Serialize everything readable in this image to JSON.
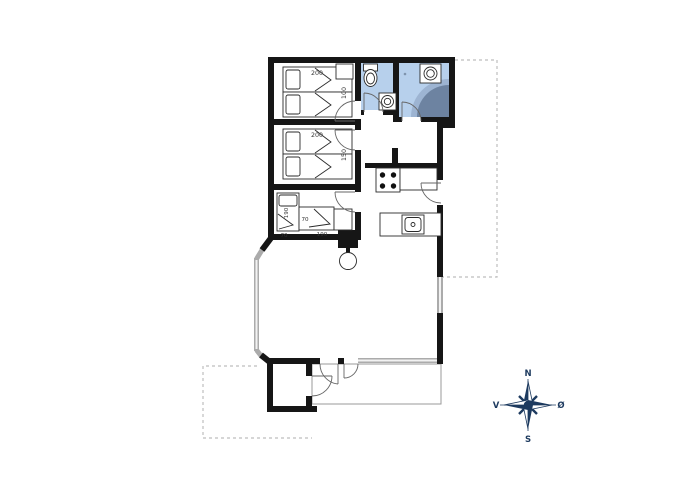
{
  "title": "Summer house floor plan",
  "colors": {
    "wall": "#161616",
    "room_blue": "#b7d0ec",
    "shower_mid": "#9db4d2",
    "shower_dark": "#6d83a1",
    "window_gray": "#ababab",
    "window_core": "#f2f2f2",
    "navy": "#1d3a5f",
    "dash_gray": "#bdbdbd",
    "thin_line": "#9a9a9a",
    "furn_stroke": "#2b2b2b",
    "label": "#333333"
  },
  "beds": {
    "b1_len": "200",
    "b1_wid": "100",
    "b2_len": "200",
    "b2_wid": "150",
    "b3a_len": "190",
    "b3a_wid": "70",
    "b3b_wid": "70",
    "b3b_len": "190"
  },
  "compass": {
    "north": "N",
    "south": "S",
    "west": "V",
    "east": "Ø"
  },
  "icons": {
    "compass": "compass-rose",
    "toilet": "toilet",
    "sinks": "washbasin",
    "shower": "corner-shower",
    "stove": "four-burner-stove",
    "wood_stove": "wood-burning-stove"
  }
}
